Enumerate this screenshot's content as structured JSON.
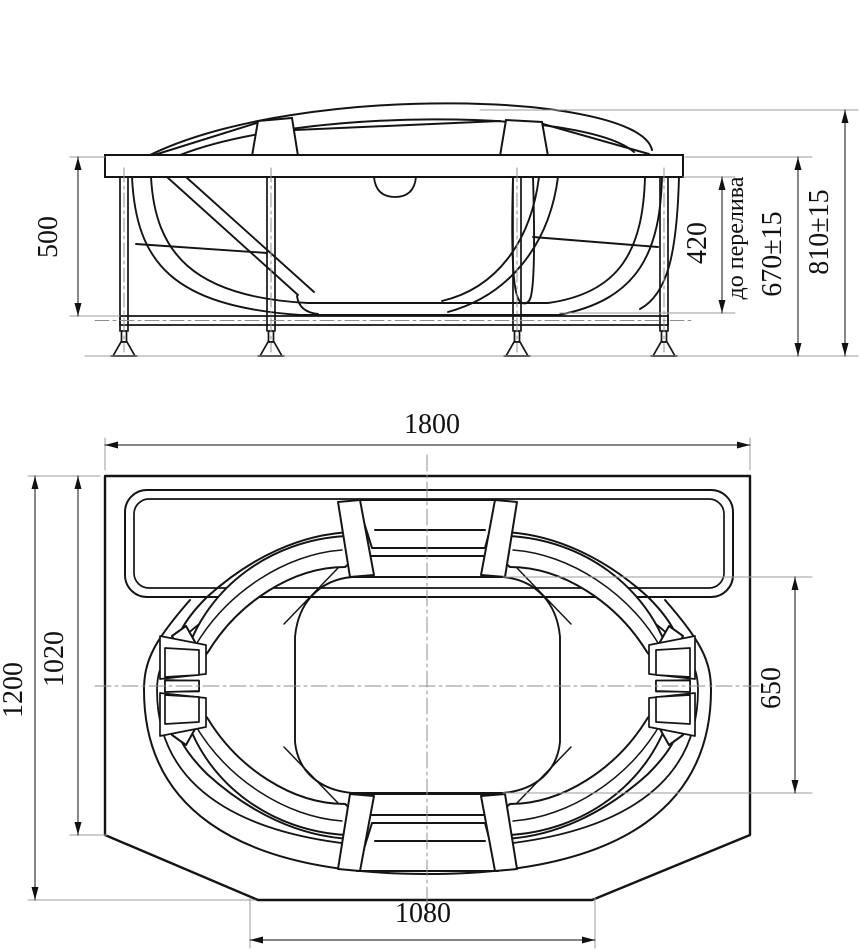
{
  "drawing": {
    "background": "#ffffff",
    "main_line_color": "#141414",
    "dimension_line_color": "#3a3a3a",
    "extension_line_color": "#9b9b9b",
    "views": {
      "front_view": {
        "title": "front-elevation-of-bathtub-on-frame",
        "dimensions": {
          "rim_to_frame_height": "500",
          "overflow_height": "420",
          "overflow_note": "до перелива",
          "rim_height_with_tolerance": "670±15",
          "overall_height_with_tolerance": "810±15"
        }
      },
      "plan_view": {
        "title": "top-plan-of-bathtub",
        "dimensions": {
          "overall_length": "1800",
          "overall_width": "1200",
          "straight_side_width": "1020",
          "inner_basin_span": "650",
          "bottom_edge_length": "1080"
        }
      }
    }
  }
}
